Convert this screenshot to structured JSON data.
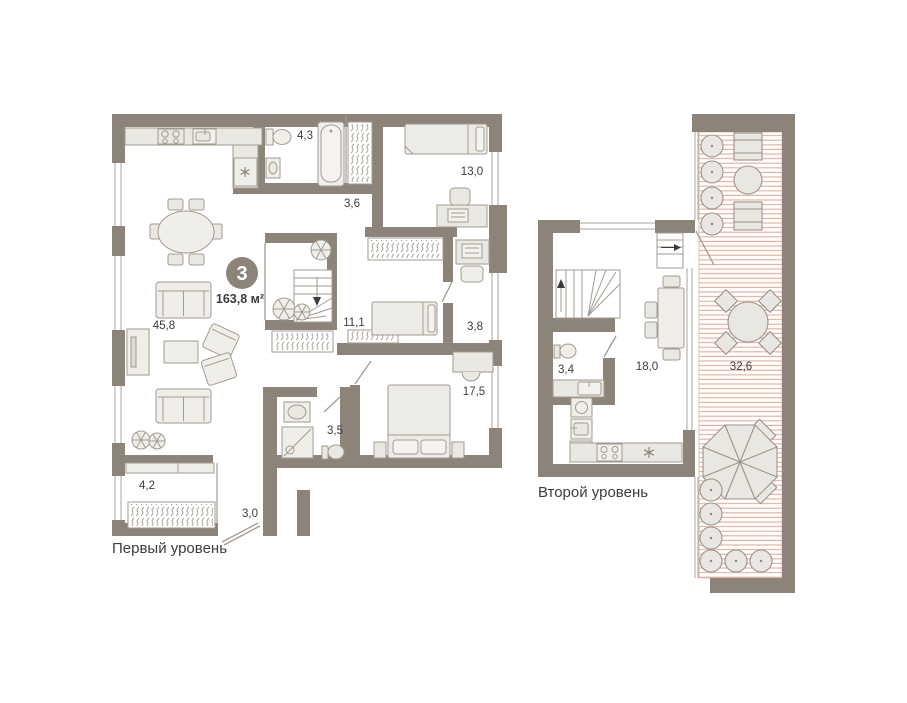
{
  "plan": {
    "badge": {
      "rooms_count": "3",
      "total_area": "163,8 м²"
    },
    "colors": {
      "wall": "#8C8478",
      "furniture_fill": "#EAE8E3",
      "furniture_stroke": "#A29B92",
      "terrace_hatch_line": "#E8AB98",
      "label_text": "#3C3C3C",
      "badge_bg": "#8C8478",
      "badge_text": "#FFFFFF"
    },
    "level1": {
      "label": "Первый уровень",
      "rooms": [
        {
          "name": "living-kitchen",
          "area": "45,8"
        },
        {
          "name": "bathroom",
          "area": "4,3"
        },
        {
          "name": "hallway",
          "area": "3,6"
        },
        {
          "name": "bedroom-1",
          "area": "13,0"
        },
        {
          "name": "bedroom-2",
          "area": "11,1"
        },
        {
          "name": "study",
          "area": "3,8"
        },
        {
          "name": "bedroom-3",
          "area": "17,5"
        },
        {
          "name": "shower-room",
          "area": "3,5"
        },
        {
          "name": "corridor",
          "area": "4,2"
        },
        {
          "name": "entry-hall",
          "area": "3,0"
        }
      ]
    },
    "level2": {
      "label": "Второй уровень",
      "rooms": [
        {
          "name": "bathroom",
          "area": "3,4"
        },
        {
          "name": "kitchen-dining",
          "area": "18,0"
        },
        {
          "name": "terrace",
          "area": "32,6"
        }
      ]
    }
  }
}
